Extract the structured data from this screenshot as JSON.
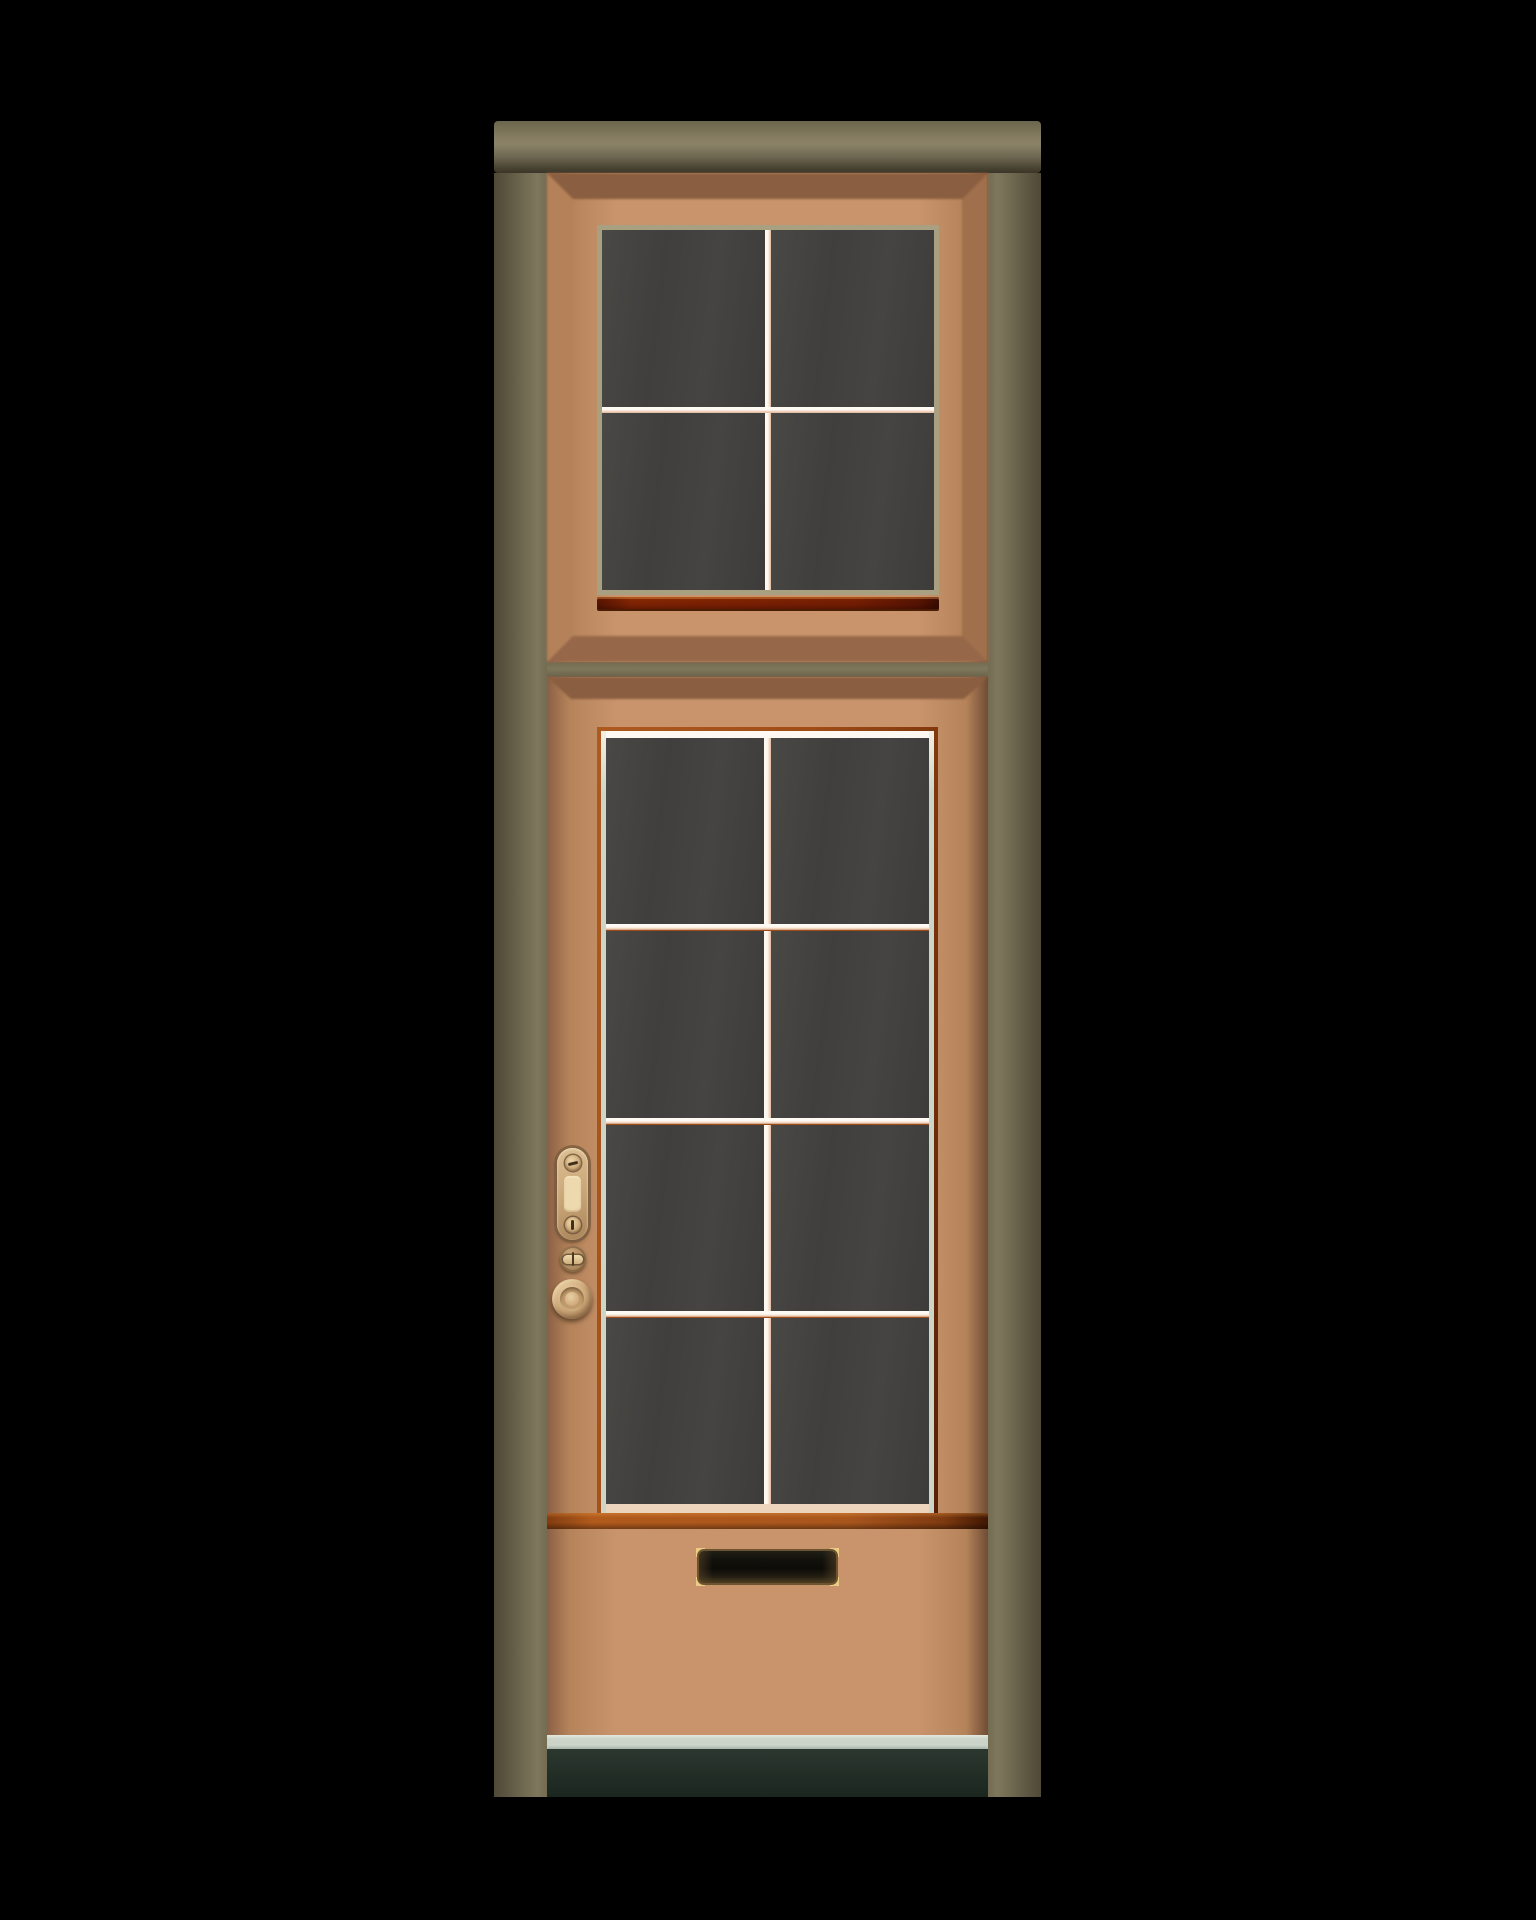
{
  "meta": {
    "description": "Illustration of a closed wooden front door with a four-pane transom window above an eight-pane glazed door leaf, brass hardware and a mail slot, set in an olive wood frame on a black background"
  },
  "scene": {
    "width_px": 1536,
    "height_px": 1920
  },
  "door_assembly": {
    "frame": {
      "label": "door-frame",
      "lintel_label": "frame-lintel",
      "left_jamb_label": "frame-left-jamb",
      "right_jamb_label": "frame-right-jamb",
      "divider_label": "frame-transom-divider"
    },
    "transom": {
      "label": "transom-panel",
      "window": {
        "label": "transom-window",
        "rows": 2,
        "cols": 2,
        "pane_count": 4,
        "muntin_px": 6,
        "style": "transom-style"
      },
      "sill_label": "transom-sill"
    },
    "door": {
      "label": "door-leaf",
      "window": {
        "label": "door-window",
        "rows": 4,
        "cols": 2,
        "pane_count": 8,
        "muntin_px": 7,
        "style": "door-style"
      },
      "rail_label": "door-bottom-rail",
      "hardware": {
        "lock_plate_label": "lock-plate",
        "lock_screw_label": "lock-plate-screw",
        "lock_cylinder_label": "lock-cylinder",
        "thumbturn_label": "deadbolt-thumbturn",
        "knob_label": "door-knob",
        "mail_slot_label": "mail-slot"
      }
    },
    "threshold_label": "threshold",
    "floor_label": "floor-shadow"
  },
  "colors": {
    "background": "#000000",
    "frame_light": "#7f775c",
    "frame_mid": "#6f6950",
    "frame_dark": "#4a4433",
    "panel_tan": "#c9946c",
    "panel_tan_dark": "#8a6044",
    "bevel_top": "#8a5e40",
    "bevel_left": "#b48159",
    "bevel_right": "#a06f4b",
    "bevel_bottom": "#97674a",
    "window_khaki": "#a8a080",
    "orange_bright": "#ad5a20",
    "orange_dark": "#581f05",
    "muntin_light": "#fdf8f1",
    "muntin_pink": "#ecc9ae",
    "glass_dark": "#434240",
    "glass_edge_green": "#ccd6c8",
    "threshold": "#ccd4ca",
    "floor_dark": "#242e27",
    "brass_light": "#eccb85",
    "brass_mid": "#b28c4a",
    "hardware_tan": "#cba778",
    "hardware_cream": "#eed9ae",
    "hardware_shadow": "#8a674a"
  }
}
